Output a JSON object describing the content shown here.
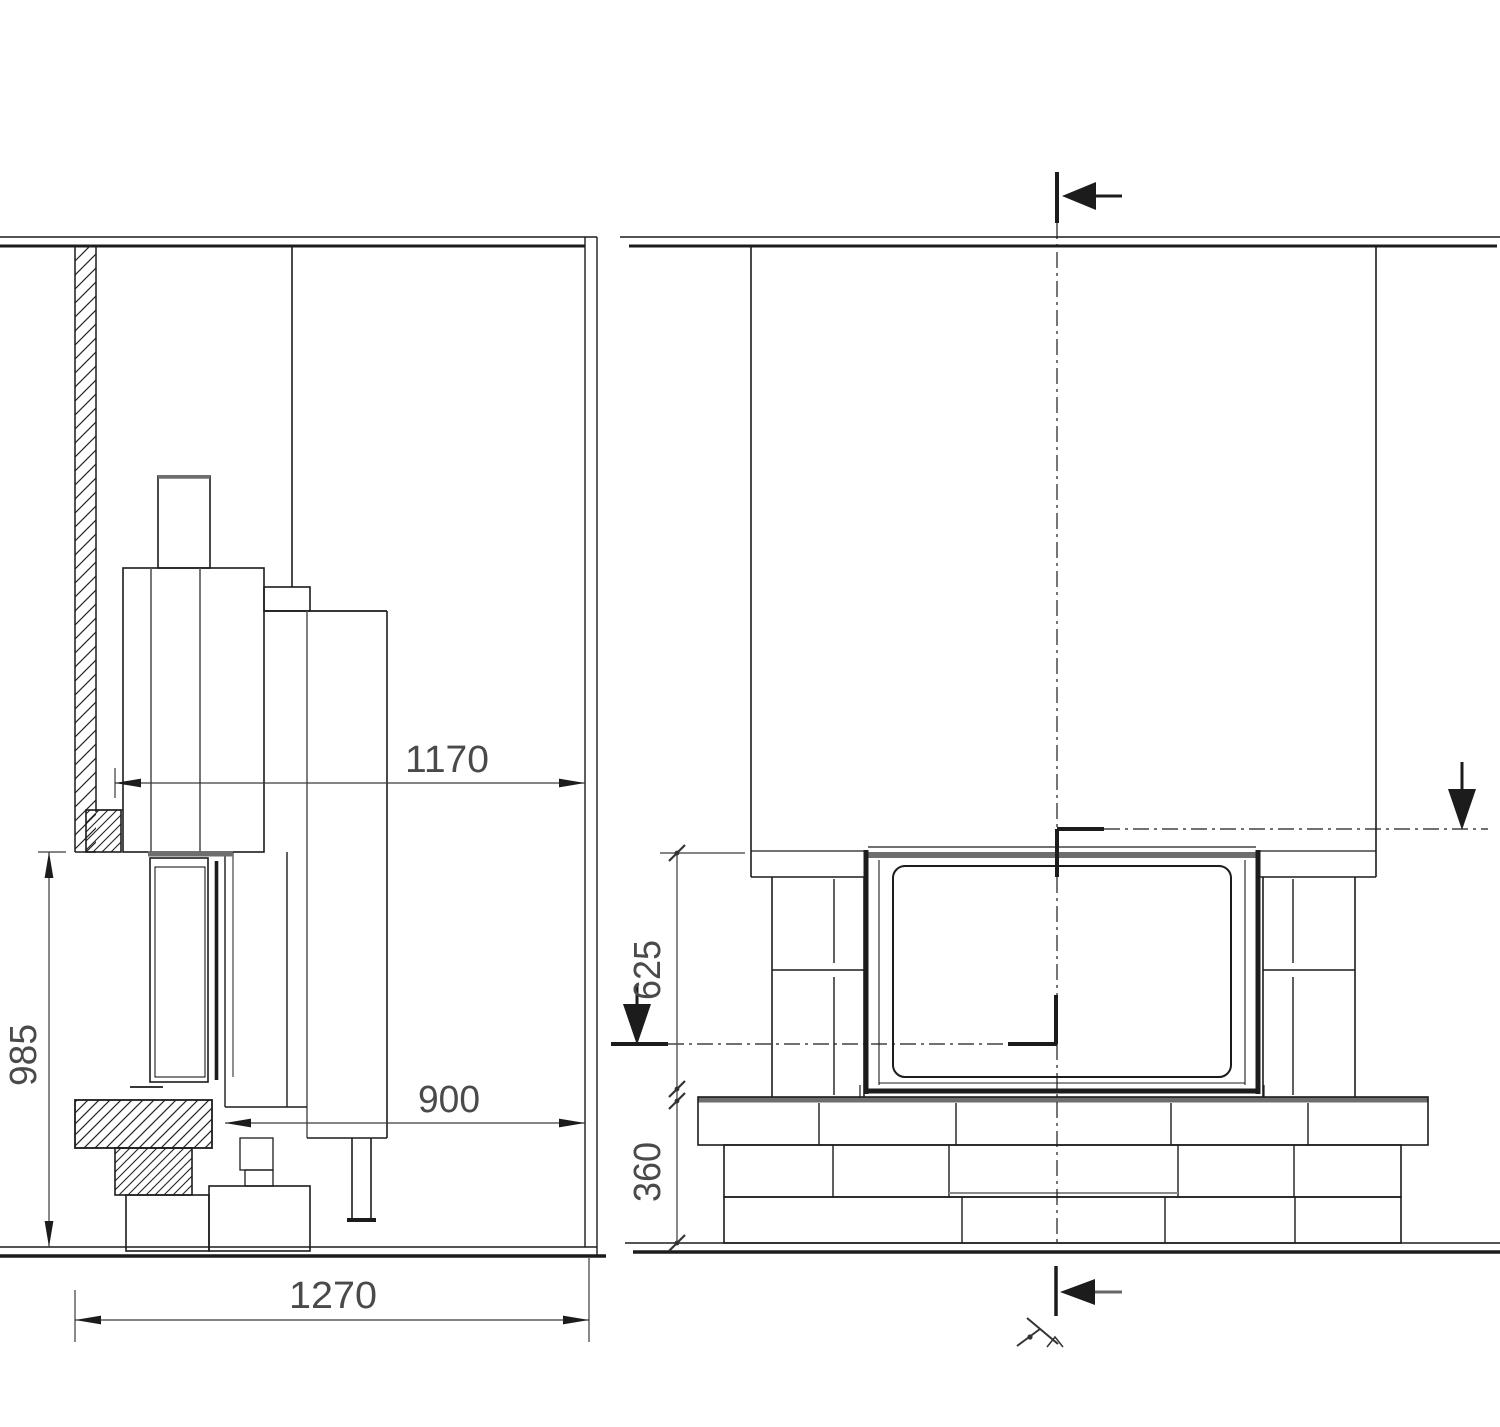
{
  "drawing": {
    "type": "technical-installation-drawing",
    "subject": "fireplace insert with chimney breast, side section and front elevation",
    "units": "mm",
    "colors": {
      "line": "#1c1c1c",
      "soft_gray": "#6e6e6e",
      "dim_line": "#555555",
      "text": "#4a4a4a",
      "background": "#ffffff"
    },
    "side_view": {
      "name": "side-section-view",
      "dims": {
        "depth_front_to_wall": "1170",
        "depth_insert": "900",
        "height_opening": "985",
        "depth_total": "1270"
      }
    },
    "front_view": {
      "name": "front-elevation-view",
      "dims": {
        "height_above_hearth": "625",
        "hearth_height": "360"
      }
    }
  }
}
